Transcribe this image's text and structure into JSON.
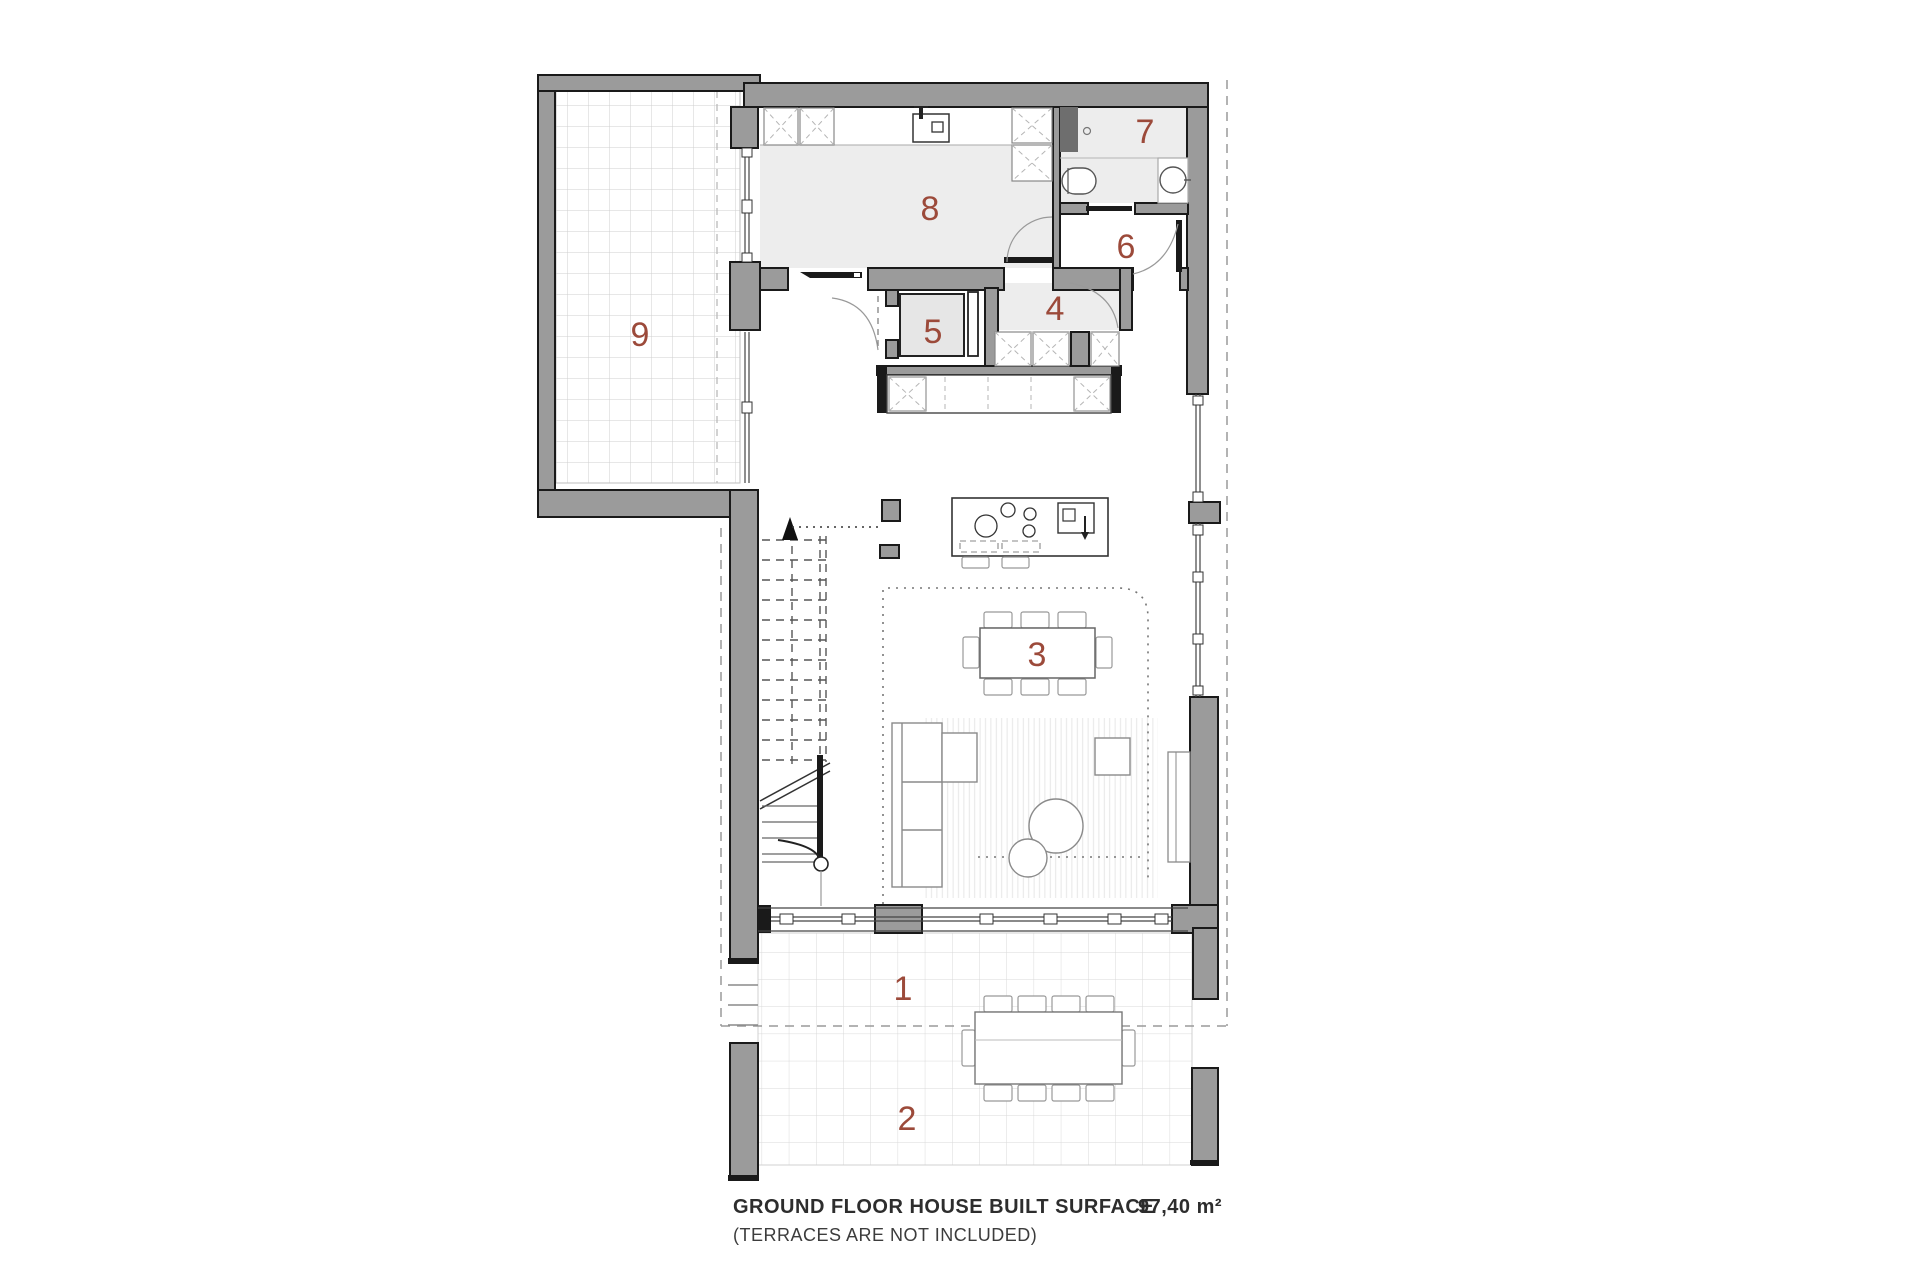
{
  "room_labels": {
    "r1": "1",
    "r2": "2",
    "r3": "3",
    "r4": "4",
    "r5": "5",
    "r6": "6",
    "r7": "7",
    "r8": "8",
    "r9": "9"
  },
  "footer": {
    "title": "GROUND FLOOR HOUSE BUILT SURFACE",
    "area": "97,40 m²",
    "note": "(TERRACES ARE NOT INCLUDED)"
  },
  "colors": {
    "label": "#9c4a3a",
    "wall": "#9b9b9b",
    "floor": "#ededed",
    "outline": "#1a1a1a"
  }
}
